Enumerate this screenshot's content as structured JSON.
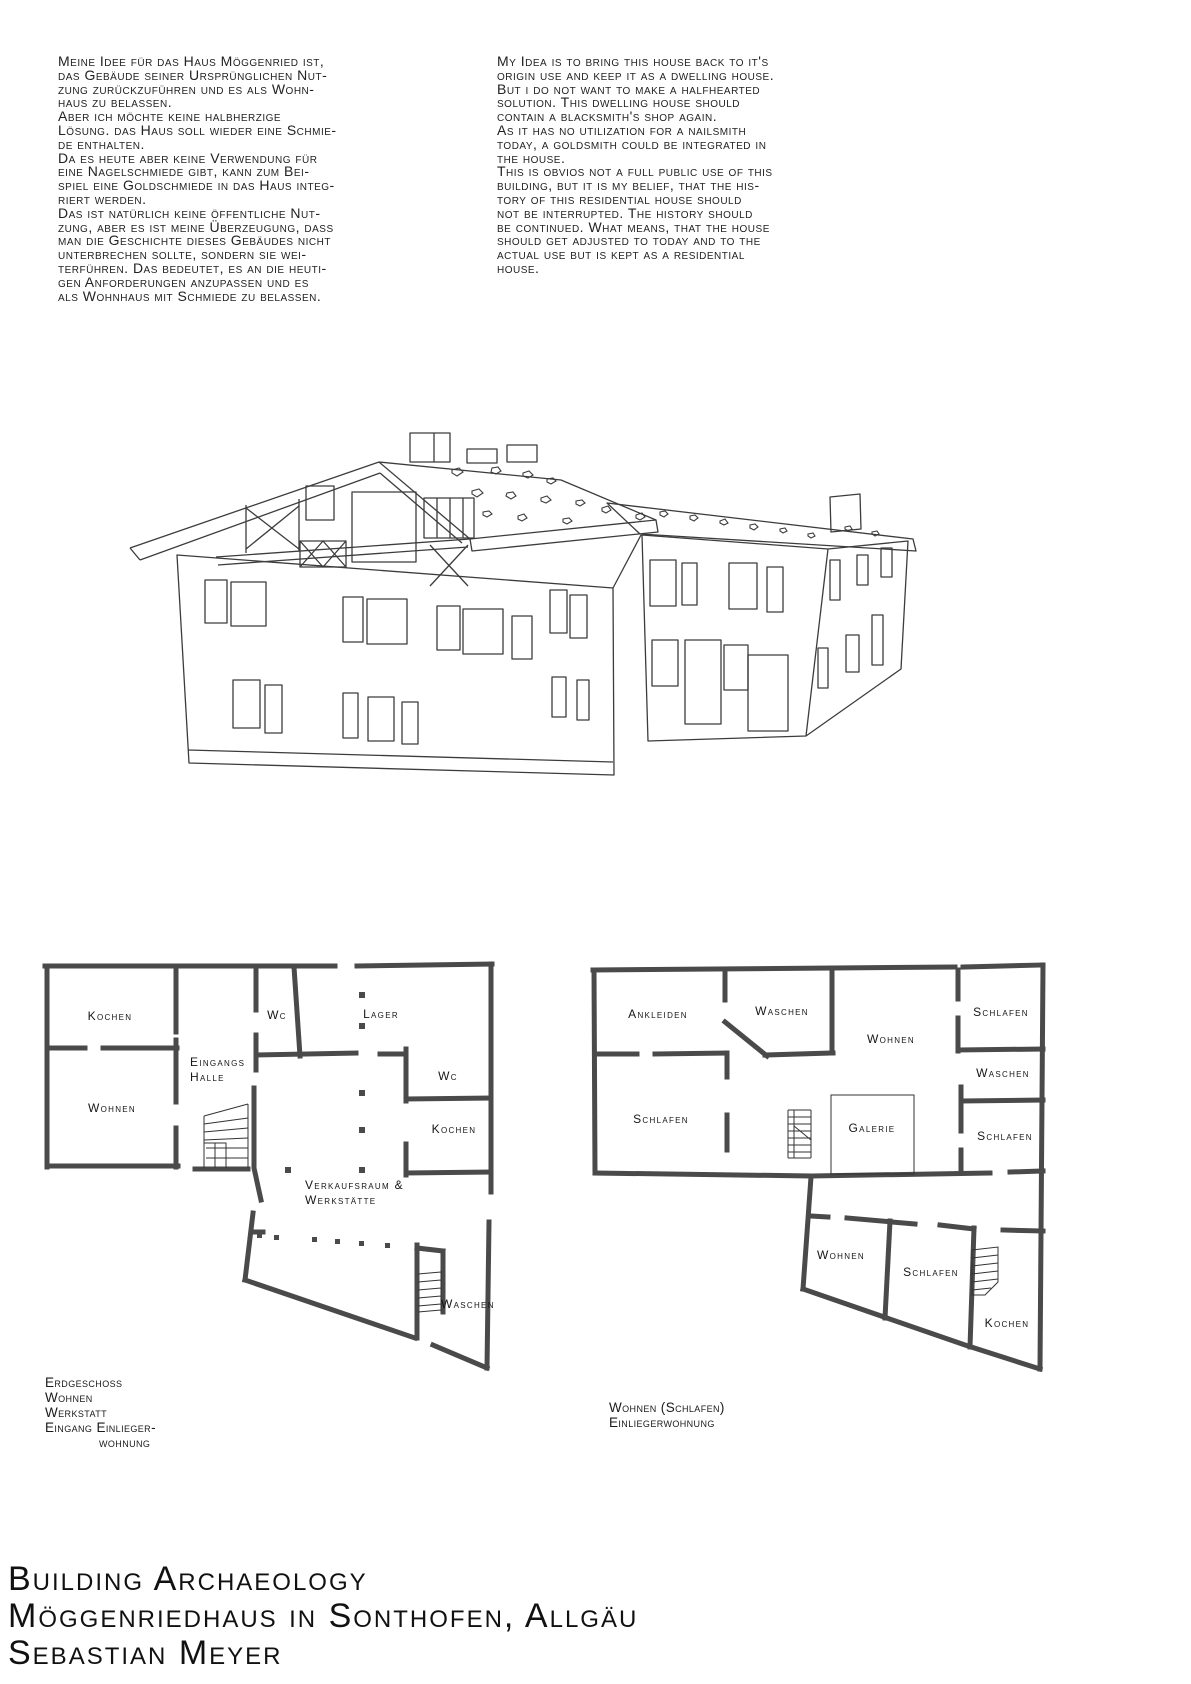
{
  "intro": {
    "german_lines": [
      "Meine Idee für das Haus Möggenried ist,",
      "das Gebäude seiner Ursprünglichen Nut-",
      "zung zurückzuführen und es als Wohn-",
      "haus zu belassen.",
      "Aber ich möchte keine halbherzige",
      "Lösung. das Haus soll wieder eine Schmie-",
      "de enthalten.",
      "Da es heute aber keine Verwendung für",
      "eine Nagelschmiede gibt, kann zum Bei-",
      "spiel eine Goldschmiede in das Haus integ-",
      "riert werden.",
      "Das ist natürlich keine öffentliche Nut-",
      "zung, aber es ist meine Überzeugung, dass",
      "man die Geschichte dieses Gebäudes nicht",
      "unterbrechen sollte, sondern sie wei-",
      "terführen. Das bedeutet, es an die heuti-",
      "gen Anforderungen anzupassen und es",
      "als Wohnhaus mit Schmiede zu belassen."
    ],
    "english_lines": [
      "My Idea is to bring this house back to it's",
      "origin use and keep it as a dwelling house.",
      "But i do not want to make a halfhearted",
      "solution. This dwelling house should",
      "contain a blacksmith's shop again.",
      "As it has no utilization for a nailsmith",
      "today, a goldsmith could be integrated in",
      "the house.",
      "This is obvios not a full public use of this",
      "building, but it is my belief, that the his-",
      "tory of this residential house should",
      "not be interrupted. The history should",
      "be continued. What means, that the house",
      "should get adjusted to today and to the",
      "actual use but is kept as a residential",
      "house."
    ]
  },
  "floorplan_left": {
    "labels": [
      "Kochen",
      "Wc",
      "Lager",
      "Eingangs",
      "Halle",
      "Wohnen",
      "Wc",
      "Kochen",
      "Verkaufsraum &",
      "Werkstätte",
      "Waschen"
    ],
    "caption_lines": [
      "Erdgeschoss",
      "Wohnen",
      "Werkstatt",
      "Eingang Einlieger-",
      "wohnung"
    ]
  },
  "floorplan_right": {
    "labels": [
      "Ankleiden",
      "Waschen",
      "Wohnen",
      "Schlafen",
      "Waschen",
      "Schlafen",
      "Galerie",
      "Schlafen",
      "Wohnen",
      "Schlafen",
      "Kochen"
    ],
    "caption_lines": [
      "Wohnen (Schlafen)",
      "Einliegerwohnung"
    ]
  },
  "footer": {
    "line1": "Building Archaeology",
    "line2": "Möggenriedhaus in Sonthofen, Allgäu",
    "line3": "Sebastian Meyer"
  }
}
